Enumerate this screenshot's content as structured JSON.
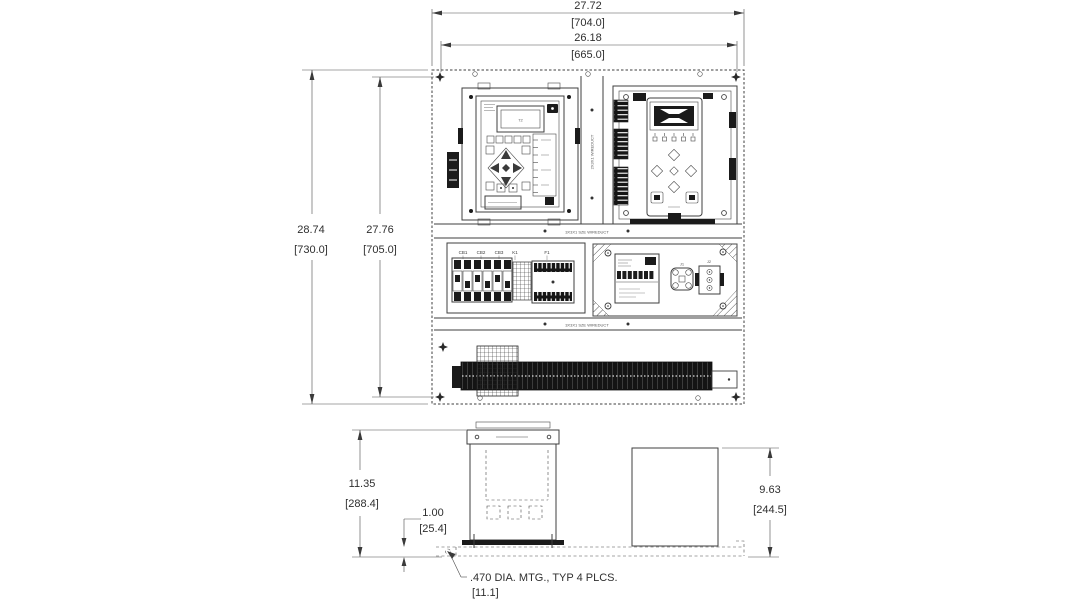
{
  "colors": {
    "ink": "#3a3a3a",
    "background": "#ffffff"
  },
  "front_view": {
    "dim_width_outer_in": "27.72",
    "dim_width_outer_mm": "[704.0]",
    "dim_width_inner_in": "26.18",
    "dim_width_inner_mm": "[665.0]",
    "dim_height_outer_in": "28.74",
    "dim_height_outer_mm": "[730.0]",
    "dim_height_inner_in": "27.76",
    "dim_height_inner_mm": "[705.0]",
    "relay_display_text": "72",
    "breaker_labels": [
      "CB1",
      "CB2",
      "CB3",
      "K1",
      "F1"
    ],
    "connector_labels": [
      "J1",
      "J2"
    ],
    "duct_label_vertical": "2X3X1 WIREDUCT",
    "duct_label_mid": "3X3X1 SZE WIREDUCT",
    "duct_label_lower": "3X3X1 SZE WIREDUCT"
  },
  "side_view": {
    "dim_height_left_in": "11.35",
    "dim_height_left_mm": "[288.4]",
    "dim_offset_in": "1.00",
    "dim_offset_mm": "[25.4]",
    "dim_height_right_in": "9.63",
    "dim_height_right_mm": "[244.5]",
    "mounting_note_line1": ".470 DIA. MTG., TYP 4 PLCS.",
    "mounting_note_line2": "[11.1]"
  }
}
